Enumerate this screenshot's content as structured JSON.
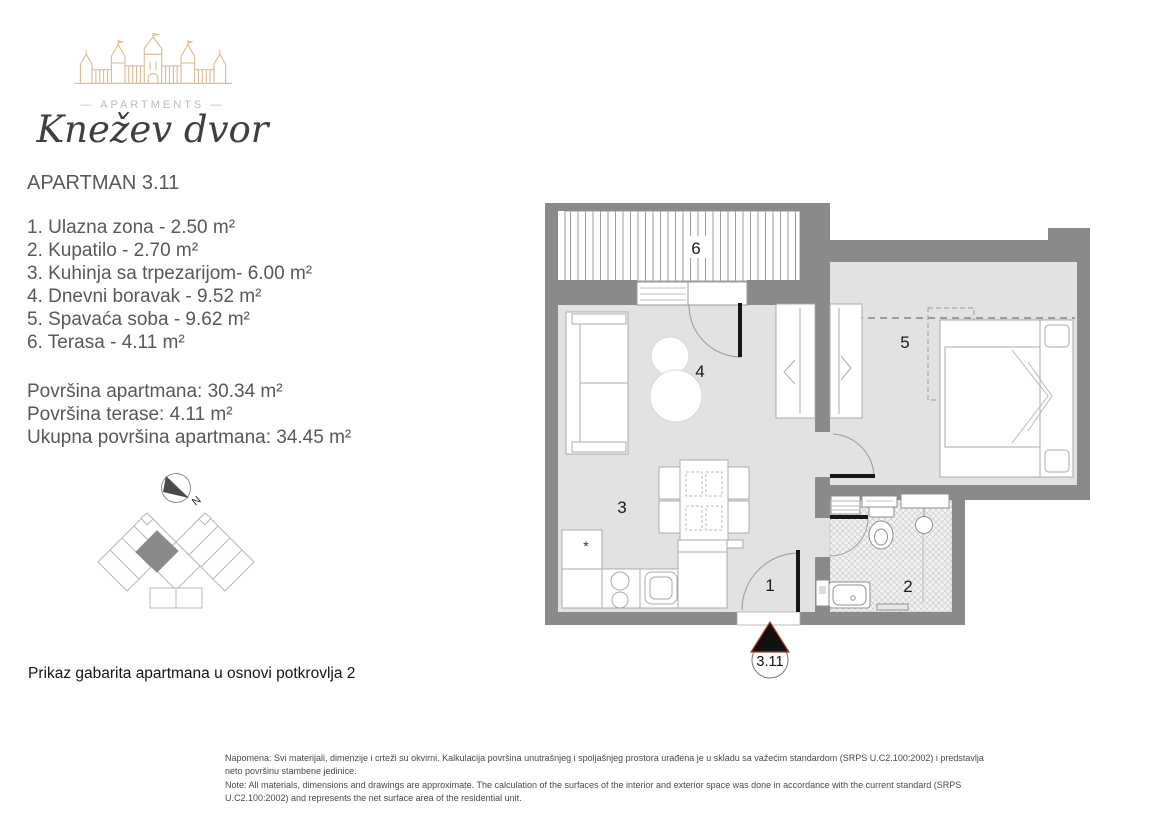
{
  "brand": {
    "apartments_label": "—  APARTMENTS  —",
    "name": "Knežev dvor"
  },
  "header": {
    "title": "APARTMAN 3.11"
  },
  "rooms": [
    {
      "number": "1",
      "name": "Ulazna zona",
      "area_m2": "2.50",
      "line": "1. Ulazna zona - 2.50 m²"
    },
    {
      "number": "2",
      "name": "Kupatilo",
      "area_m2": "2.70",
      "line": "2. Kupatilo - 2.70 m²"
    },
    {
      "number": "3",
      "name": "Kuhinja sa trpezarijom",
      "area_m2": "6.00",
      "line": "3. Kuhinja sa trpezarijom- 6.00 m²"
    },
    {
      "number": "4",
      "name": "Dnevni boravak",
      "area_m2": "9.52",
      "line": "4. Dnevni boravak - 9.52 m²"
    },
    {
      "number": "5",
      "name": "Spavaća soba",
      "area_m2": "9.62",
      "line": "5. Spavaća soba - 9.62 m²"
    },
    {
      "number": "6",
      "name": "Terasa",
      "area_m2": "4.11",
      "line": "6. Terasa - 4.11 m²"
    }
  ],
  "summary": {
    "area_line": "Površina apartmana: 30.34 m²",
    "terrace_line": "Površina terase: 4.11 m²",
    "total_line": "Ukupna površina apartmana: 34.45 m²"
  },
  "caption": "Prikaz gabarita apartmana u osnovi potkrovlja 2",
  "plan": {
    "numbers": {
      "entry": "1",
      "bathroom": "2",
      "kitchen": "3",
      "living": "4",
      "bedroom": "5",
      "terrace": "6"
    },
    "entrance_label": "3.11",
    "compass_label": "N",
    "kitchen_star": "*"
  },
  "notes": {
    "line1": "Napomena: Svi materijali, dimenzije i crteži su okvirni. Kalkulacija površina unutrašnjeg i spoljašnjeg prostora urađena je u skladu sa važećim standardom (SRPS U.C2.100:2002) i predstavlja",
    "line2": "neto površinu stambene jedinice.",
    "line3": "Note: All materials, dimensions and drawings are approximate. The calculation of the surfaces of the interior and exterior space was done in accordance with the current standard (SRPS",
    "line4": "U.C2.100:2002) and represents the net surface area of the residential unit."
  },
  "colors": {
    "wall": "#8a8a8a",
    "floor": "#e2e2e2",
    "logo_gold": "#d8ba8e",
    "marker_outline": "#a94428",
    "text_gray": "#57585a"
  }
}
